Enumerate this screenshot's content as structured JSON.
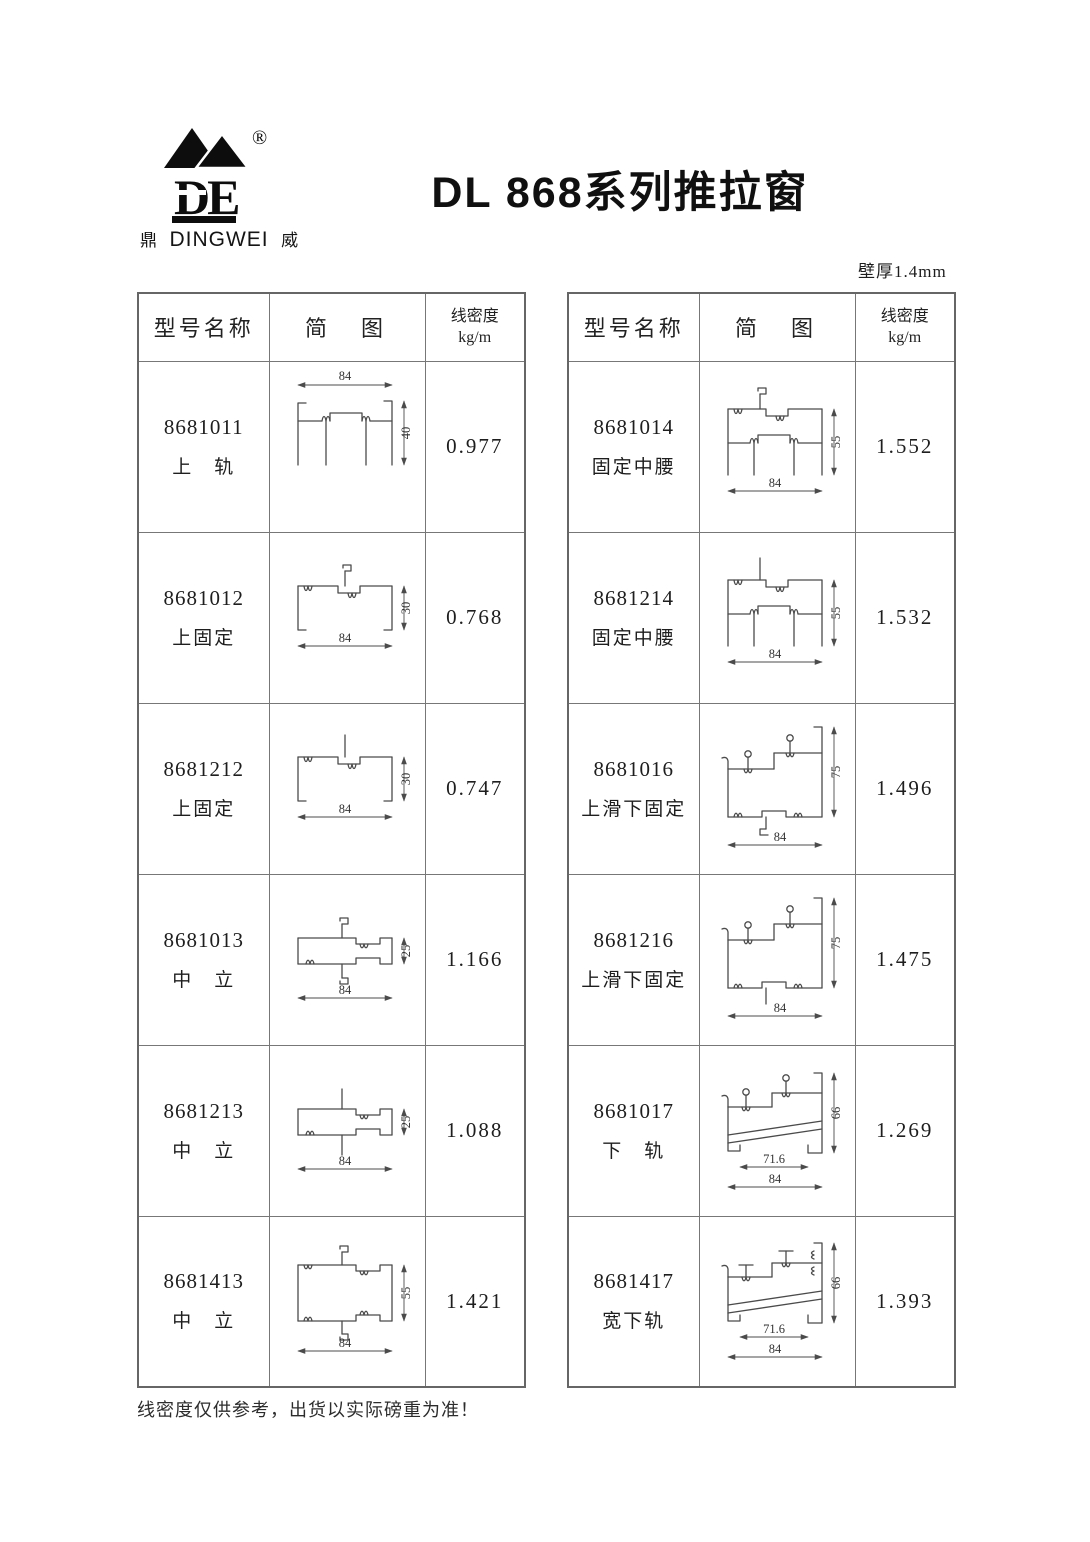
{
  "header": {
    "brand": {
      "monogram": "DE",
      "registered": "®",
      "mark_left": "鼎",
      "name_en": "DINGWEI",
      "mark_right": "威"
    },
    "title": "DL 868系列推拉窗",
    "wall_thickness": "壁厚1.4mm"
  },
  "table": {
    "col_model": "型号名称",
    "col_diagram": "简　图",
    "col_density_l1": "线密度",
    "col_density_l2": "kg/m"
  },
  "left_table": {
    "rows": [
      {
        "model": "8681011",
        "name": "上　轨",
        "density": "0.977",
        "dims": {
          "w": "84",
          "h": "40"
        }
      },
      {
        "model": "8681012",
        "name": "上固定",
        "density": "0.768",
        "dims": {
          "w": "84",
          "h": "30"
        }
      },
      {
        "model": "8681212",
        "name": "上固定",
        "density": "0.747",
        "dims": {
          "w": "84",
          "h": "30"
        }
      },
      {
        "model": "8681013",
        "name": "中　立",
        "density": "1.166",
        "dims": {
          "w": "84",
          "h": "25"
        }
      },
      {
        "model": "8681213",
        "name": "中　立",
        "density": "1.088",
        "dims": {
          "w": "84",
          "h": "25"
        }
      },
      {
        "model": "8681413",
        "name": "中　立",
        "density": "1.421",
        "dims": {
          "w": "84",
          "h": "55"
        }
      }
    ]
  },
  "right_table": {
    "rows": [
      {
        "model": "8681014",
        "name": "固定中腰",
        "density": "1.552",
        "dims": {
          "w": "84",
          "h": "55"
        }
      },
      {
        "model": "8681214",
        "name": "固定中腰",
        "density": "1.532",
        "dims": {
          "w": "84",
          "h": "55"
        }
      },
      {
        "model": "8681016",
        "name": "上滑下固定",
        "density": "1.496",
        "dims": {
          "w": "84",
          "h": "75"
        }
      },
      {
        "model": "8681216",
        "name": "上滑下固定",
        "density": "1.475",
        "dims": {
          "w": "84",
          "h": "75"
        }
      },
      {
        "model": "8681017",
        "name": "下　轨",
        "density": "1.269",
        "dims": {
          "w": "84",
          "w_inner": "71.6",
          "h": "66"
        }
      },
      {
        "model": "8681417",
        "name": "宽下轨",
        "density": "1.393",
        "dims": {
          "w": "84",
          "w_inner": "71.6",
          "h": "66"
        }
      }
    ]
  },
  "footer": {
    "note": "线密度仅供参考，出货以实际磅重为准！"
  }
}
